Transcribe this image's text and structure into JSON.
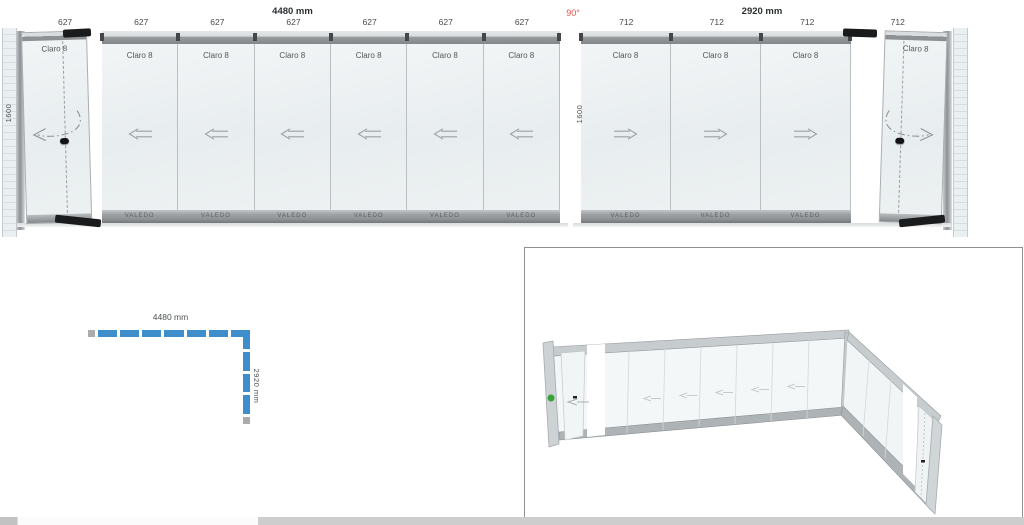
{
  "colors": {
    "plan_blue": "#3e8ecb",
    "angle_red": "#e0564e"
  },
  "angle_label": "90°",
  "left_elevation": {
    "title": "4480 mm",
    "height_label": "1600",
    "dims": [
      "627",
      "627",
      "627",
      "627",
      "627",
      "627",
      "627"
    ],
    "brand": "VALEDO",
    "panels": [
      {
        "label": "Claro 8",
        "type": "swing-door-left"
      },
      {
        "label": "Claro 8",
        "type": "sliding-left"
      },
      {
        "label": "Claro 8",
        "type": "sliding-left"
      },
      {
        "label": "Claro 8",
        "type": "sliding-left"
      },
      {
        "label": "Claro 8",
        "type": "sliding-left"
      },
      {
        "label": "Claro 8",
        "type": "sliding-left"
      },
      {
        "label": "Claro 8",
        "type": "sliding-left"
      }
    ]
  },
  "right_elevation": {
    "title": "2920 mm",
    "height_label": "1600",
    "dims": [
      "712",
      "712",
      "712",
      "712"
    ],
    "brand": "VALEDO",
    "panels": [
      {
        "label": "Claro 8",
        "type": "sliding-right"
      },
      {
        "label": "Claro 8",
        "type": "sliding-right"
      },
      {
        "label": "Claro 8",
        "type": "sliding-right"
      },
      {
        "label": "Claro 8",
        "type": "swing-door-right"
      }
    ]
  },
  "plan": {
    "width_label": "4480 mm",
    "depth_label": "2920 mm",
    "horizontal_segments": 7,
    "vertical_segments": 4
  }
}
